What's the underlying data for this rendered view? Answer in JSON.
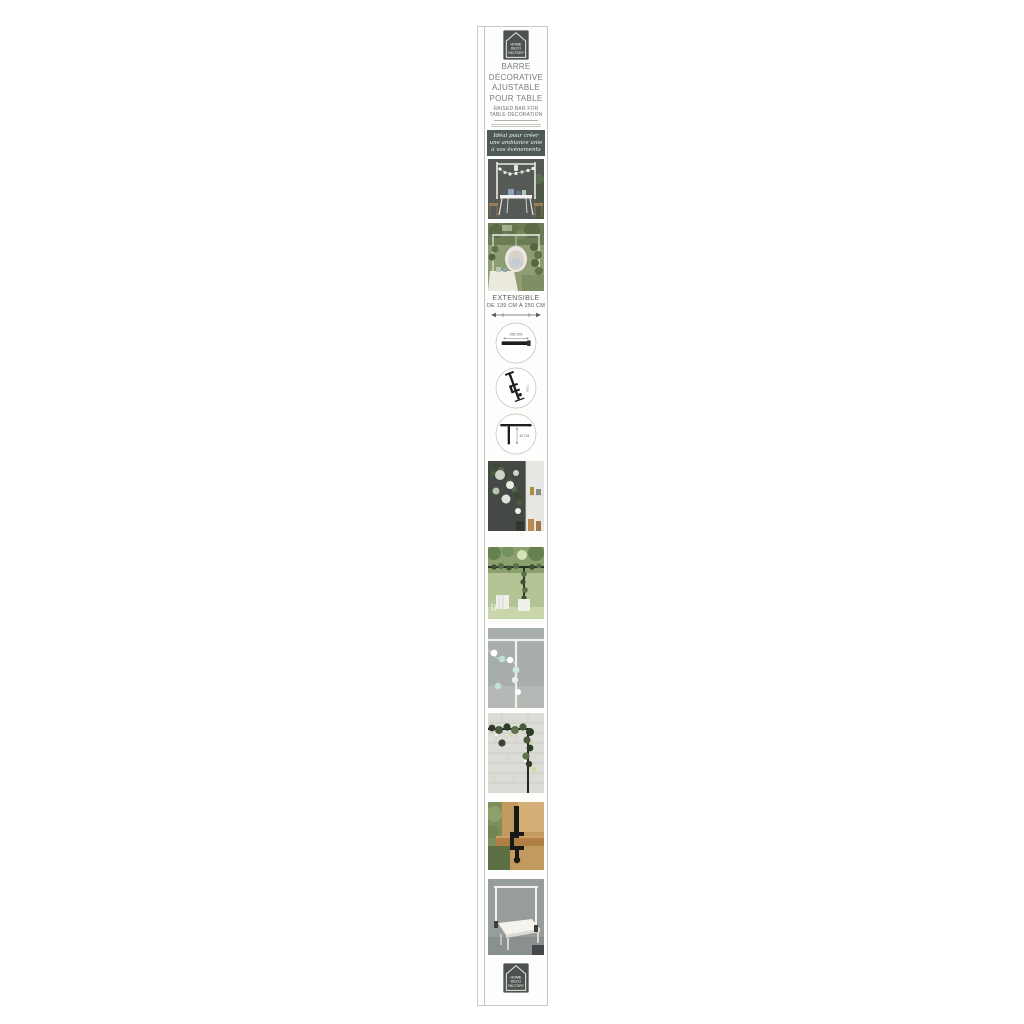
{
  "brand": {
    "lines": [
      "HOME",
      "DECO",
      "FACTORY"
    ]
  },
  "header": {
    "title_lines": [
      "BARRE",
      "DÉCORATIVE",
      "AJUSTABLE",
      "POUR TABLE"
    ],
    "subtitle_lines": [
      "RAISED BAR FOR",
      "TABLE DECORATION"
    ],
    "tagline_lines": [
      "Idéal pour créer",
      "une ambiance unie",
      "à vos événements"
    ]
  },
  "specs": {
    "extensible_line1": "EXTENSIBLE",
    "extensible_line2": "DE 139 CM À 250 CM",
    "diagram_bar_length": "250 CM",
    "diagram_clamp_depth": "7 CM",
    "diagram_drop_height": "40 CM"
  },
  "colors": {
    "logo_bg": "#4c534f",
    "band_bg": "#4f5a54",
    "title_text": "#7b807e",
    "box_border": "#c6c6c0",
    "diagram_black": "#1c1e1b"
  }
}
